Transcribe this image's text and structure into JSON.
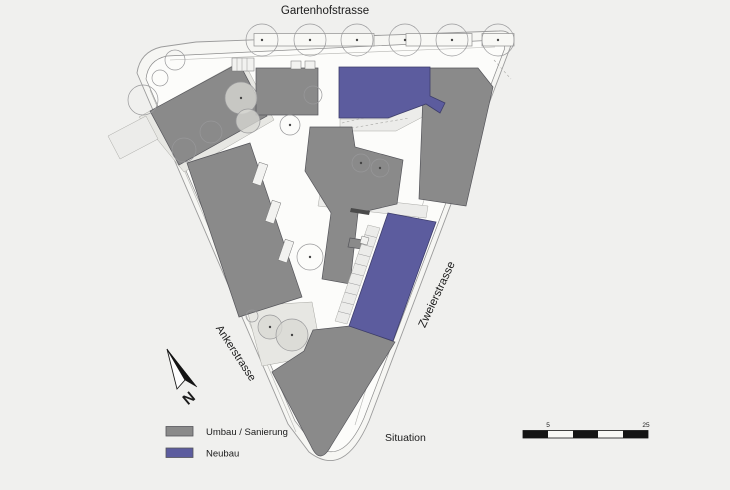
{
  "plan": {
    "streets": {
      "top": "Gartenhofstrasse",
      "left": "Ankerstrasse",
      "right": "Zweierstrasse"
    },
    "caption": "Situation",
    "north_label": "N"
  },
  "legend": {
    "items": [
      {
        "label": "Umbau / Sanierung",
        "color": "#8a8a8a"
      },
      {
        "label": "Neubau",
        "color": "#5c5c9e"
      }
    ]
  },
  "scalebar": {
    "tick_5": "5",
    "tick_25": "25"
  },
  "colors": {
    "background": "#f0f0ee",
    "umbau": "#8a8a8a",
    "neubau": "#5c5c9e",
    "site_fill": "#fcfcfa",
    "line": "#8d8d8d"
  }
}
